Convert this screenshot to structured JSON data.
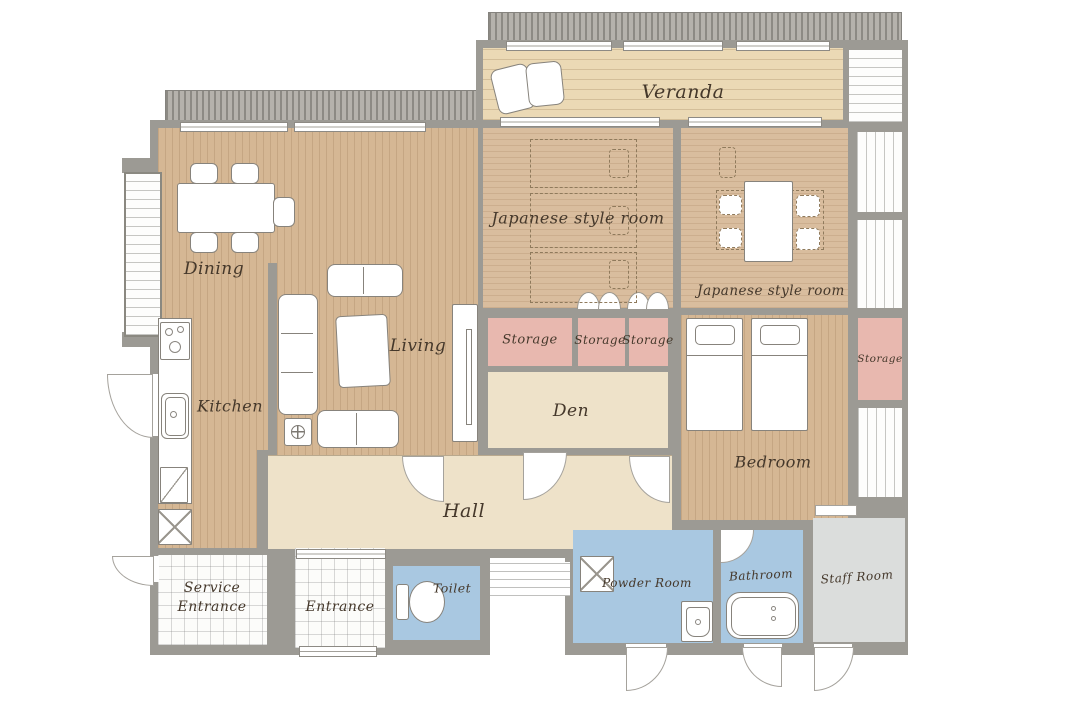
{
  "rooms": {
    "veranda": {
      "label": "Veranda"
    },
    "jp_room_top": {
      "label": "Japanese style room"
    },
    "jp_room_right": {
      "label": "Japanese style room"
    },
    "dining": {
      "label": "Dining"
    },
    "living": {
      "label": "Living"
    },
    "kitchen": {
      "label": "Kitchen"
    },
    "storage_1": {
      "label": "Storage"
    },
    "storage_2": {
      "label": "Storage"
    },
    "storage_3": {
      "label": "Storage"
    },
    "storage_right": {
      "label": "Storage"
    },
    "den": {
      "label": "Den"
    },
    "hall": {
      "label": "Hall"
    },
    "bedroom": {
      "label": "Bedroom"
    },
    "service_entrance": {
      "line1": "Service",
      "line2": "Entrance"
    },
    "entrance": {
      "label": "Entrance"
    },
    "toilet": {
      "label": "Toilet"
    },
    "powder_room": {
      "label": "Powder Room"
    },
    "bathroom": {
      "label": "Bathroom"
    },
    "staff_room": {
      "label": "Staff Room"
    }
  },
  "colors": {
    "wall": "#9c9a94",
    "wood_floor": "#d5b794",
    "tatami": "#d9bd9e",
    "veranda_deck": "#ebd9b5",
    "hall_beige": "#eee2c9",
    "storage_pink": "#e8b8af",
    "wet_area_blue": "#a9c8e1",
    "staff_room_gray": "#dbdddc",
    "exterior_hatch": "#b5b2ac",
    "tile_white": "#fcfcfa",
    "label_ink": "#45382b"
  },
  "icons": {
    "veranda": [
      "lounge-chair-icon"
    ],
    "dining": [
      "dining-table-icon",
      "dining-chair-icon"
    ],
    "living": [
      "sofa-icon",
      "loveseat-icon",
      "coffee-table-icon",
      "side-table-icon",
      "tv-board-icon"
    ],
    "kitchen": [
      "stove-icon",
      "kitchen-sink-icon",
      "kitchen-cabinet-icon",
      "refrigerator-icon"
    ],
    "jp_room_top": [
      "futon-icon",
      "pillow-icon",
      "sliding-door-fan-icon"
    ],
    "jp_room_right": [
      "low-table-icon",
      "floor-cushion-icon"
    ],
    "bedroom": [
      "single-bed-icon"
    ],
    "toilet": [
      "toilet-icon"
    ],
    "powder_room": [
      "washing-machine-icon",
      "washbasin-icon"
    ],
    "bathroom": [
      "bathtub-icon",
      "shower-arc-icon"
    ],
    "doors": [
      "door-arc-icon",
      "window",
      "step-lines"
    ]
  }
}
